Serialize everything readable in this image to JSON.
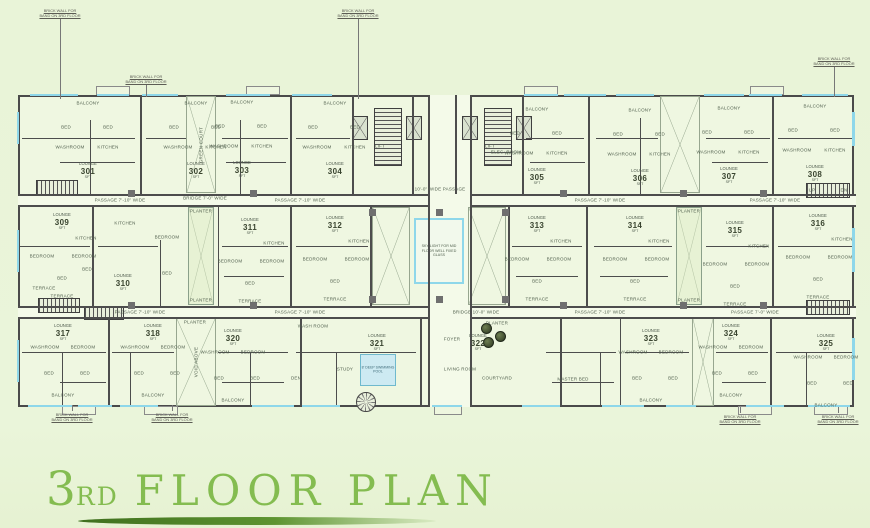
{
  "title": {
    "ordinal_number": "3",
    "ordinal_suffix": "RD",
    "main": "FLOOR PLAN"
  },
  "colors": {
    "background": "#e9f4d8",
    "plan_fill": "#eff7e1",
    "wall": "#4d4d4d",
    "window": "#8ed7ea",
    "title_green": "#84bc50",
    "swoosh_green": "#4a7b24",
    "tiny_text": "#51604e"
  },
  "plan": {
    "unit_top_label": "LOUNGE",
    "unit_area_unit": "SFT",
    "brick_note": [
      "BRICK WALL FOR",
      "BAND ON 3RD FLOOR"
    ],
    "units": [
      [
        "301",
        88,
        171,
        "top"
      ],
      [
        "302",
        196,
        171,
        "top"
      ],
      [
        "303",
        242,
        170,
        "top"
      ],
      [
        "304",
        335,
        171,
        "top"
      ],
      [
        "305",
        537,
        177,
        "top"
      ],
      [
        "306",
        640,
        178,
        "top"
      ],
      [
        "307",
        729,
        176,
        "top"
      ],
      [
        "308",
        815,
        174,
        "top"
      ],
      [
        "309",
        62,
        222,
        "mid"
      ],
      [
        "310",
        123,
        283,
        "mid2"
      ],
      [
        "311",
        250,
        227,
        "mid"
      ],
      [
        "312",
        335,
        225,
        "mid"
      ],
      [
        "313",
        537,
        225,
        "mid"
      ],
      [
        "314",
        635,
        225,
        "mid"
      ],
      [
        "315",
        735,
        230,
        "mid"
      ],
      [
        "316",
        818,
        223,
        "mid"
      ],
      [
        "317",
        63,
        333,
        "bottom"
      ],
      [
        "318",
        153,
        333,
        "bottom"
      ],
      [
        "320",
        233,
        338,
        "bottom"
      ],
      [
        "321",
        377,
        343,
        "none"
      ],
      [
        "322",
        478,
        343,
        "none"
      ],
      [
        "323",
        651,
        338,
        "bottom"
      ],
      [
        "324",
        731,
        333,
        "bottom"
      ],
      [
        "325",
        826,
        343,
        "bottom"
      ]
    ],
    "room_patterns": {
      "top": [
        [
          "BALCONY",
          0,
          -68
        ],
        [
          "BED",
          -22,
          -44
        ],
        [
          "BED",
          20,
          -44
        ],
        [
          "WASHROOM",
          -18,
          -24
        ],
        [
          "KITCHEN",
          20,
          -24
        ]
      ],
      "mid": [
        [
          "KITCHEN",
          24,
          16
        ],
        [
          "BEDROOM",
          -20,
          34
        ],
        [
          "BEDROOM",
          22,
          34
        ],
        [
          "BED",
          0,
          56
        ],
        [
          "TERRACE",
          0,
          74
        ]
      ],
      "mid2": [
        [
          "BEDROOM",
          44,
          -46
        ],
        [
          "KITCHEN",
          2,
          -60
        ],
        [
          "BED",
          -36,
          -14
        ],
        [
          "BED",
          44,
          -10
        ]
      ],
      "bottom": [
        [
          "WASHROOM",
          -18,
          14
        ],
        [
          "BEDROOM",
          20,
          14
        ],
        [
          "BED",
          -14,
          40
        ],
        [
          "BED",
          22,
          40
        ],
        [
          "BALCONY",
          0,
          62
        ]
      ],
      "none": []
    },
    "corridors": [
      [
        18,
        196,
        410,
        9
      ],
      [
        470,
        196,
        386,
        9
      ],
      [
        18,
        308,
        410,
        9
      ],
      [
        470,
        308,
        386,
        9
      ],
      [
        429.5,
        95,
        40.5,
        312
      ]
    ],
    "walls": [
      [
        18,
        194,
        410,
        1.5
      ],
      [
        470,
        194,
        386,
        1.5
      ],
      [
        18,
        205,
        410,
        1.5
      ],
      [
        470,
        205,
        386,
        1.5
      ],
      [
        18,
        306,
        410,
        1.5
      ],
      [
        470,
        306,
        386,
        1.5
      ],
      [
        18,
        317,
        410,
        1.5
      ],
      [
        470,
        317,
        386,
        1.5
      ],
      [
        428,
        95,
        1.5,
        312
      ],
      [
        470,
        95,
        1.5,
        312
      ],
      [
        140,
        95,
        1.5,
        99
      ],
      [
        290,
        95,
        1.5,
        99
      ],
      [
        352,
        95,
        1.5,
        99
      ],
      [
        412,
        95,
        1.5,
        99
      ],
      [
        455,
        95,
        1.5,
        99
      ],
      [
        522,
        95,
        1.5,
        99
      ],
      [
        588,
        95,
        1.5,
        99
      ],
      [
        772,
        95,
        1.5,
        99
      ],
      [
        90,
        120,
        1,
        74
      ],
      [
        240,
        120,
        1,
        74
      ],
      [
        640,
        118,
        1,
        76
      ],
      [
        22,
        138,
        113,
        1
      ],
      [
        146,
        138,
        40,
        1
      ],
      [
        222,
        138,
        66,
        1
      ],
      [
        296,
        138,
        54,
        1
      ],
      [
        526,
        138,
        58,
        1
      ],
      [
        596,
        138,
        62,
        1
      ],
      [
        706,
        138,
        64,
        1
      ],
      [
        778,
        138,
        76,
        1
      ],
      [
        60,
        162,
        75,
        1
      ],
      [
        226,
        162,
        60,
        1
      ],
      [
        530,
        162,
        55,
        1
      ],
      [
        712,
        162,
        56,
        1
      ],
      [
        92,
        206,
        1.5,
        100
      ],
      [
        290,
        206,
        1.5,
        100
      ],
      [
        586,
        206,
        1.5,
        100
      ],
      [
        772,
        206,
        1.5,
        100
      ],
      [
        370,
        206,
        1.5,
        100
      ],
      [
        508,
        206,
        1.5,
        100
      ],
      [
        160,
        240,
        1,
        66
      ],
      [
        218,
        206,
        1,
        100
      ],
      [
        20,
        246,
        70,
        1
      ],
      [
        98,
        246,
        60,
        1
      ],
      [
        222,
        246,
        66,
        1
      ],
      [
        296,
        246,
        72,
        1
      ],
      [
        512,
        246,
        70,
        1
      ],
      [
        594,
        246,
        78,
        1
      ],
      [
        706,
        246,
        62,
        1
      ],
      [
        778,
        246,
        74,
        1
      ],
      [
        224,
        276,
        60,
        1
      ],
      [
        516,
        276,
        62,
        1
      ],
      [
        600,
        276,
        68,
        1
      ],
      [
        108,
        318,
        1.5,
        88
      ],
      [
        300,
        318,
        1.5,
        88
      ],
      [
        420,
        318,
        1.5,
        88
      ],
      [
        560,
        318,
        1.5,
        88
      ],
      [
        620,
        318,
        1,
        88
      ],
      [
        770,
        318,
        1.5,
        88
      ],
      [
        62,
        352,
        1,
        54
      ],
      [
        130,
        352,
        1,
        54
      ],
      [
        250,
        352,
        1,
        54
      ],
      [
        336,
        352,
        1,
        54
      ],
      [
        600,
        352,
        1,
        54
      ],
      [
        806,
        352,
        1,
        54
      ],
      [
        22,
        352,
        84,
        1
      ],
      [
        112,
        352,
        62,
        1
      ],
      [
        218,
        352,
        70,
        1
      ],
      [
        296,
        352,
        120,
        1
      ],
      [
        546,
        352,
        70,
        1
      ],
      [
        625,
        352,
        64,
        1
      ],
      [
        716,
        352,
        52,
        1
      ],
      [
        776,
        352,
        76,
        1
      ],
      [
        60,
        382,
        46,
        1
      ],
      [
        222,
        382,
        62,
        1
      ],
      [
        552,
        382,
        62,
        1
      ],
      [
        722,
        382,
        44,
        1
      ]
    ],
    "windows": [
      [
        30,
        93.5,
        48,
        2.5
      ],
      [
        97,
        93.5,
        32,
        2.5
      ],
      [
        142,
        93.5,
        36,
        2.5
      ],
      [
        226,
        93.5,
        44,
        2.5
      ],
      [
        292,
        93.5,
        40,
        2.5
      ],
      [
        524,
        93.5,
        34,
        2.5
      ],
      [
        564,
        93.5,
        42,
        2.5
      ],
      [
        616,
        93.5,
        38,
        2.5
      ],
      [
        704,
        93.5,
        40,
        2.5
      ],
      [
        749,
        93.5,
        33,
        2.5
      ],
      [
        802,
        93.5,
        46,
        2.5
      ],
      [
        28,
        404.5,
        44,
        2.5
      ],
      [
        78,
        404.5,
        34,
        2.5
      ],
      [
        120,
        404.5,
        38,
        2.5
      ],
      [
        252,
        404.5,
        42,
        2.5
      ],
      [
        302,
        404.5,
        38,
        2.5
      ],
      [
        432,
        404.5,
        30,
        2.5
      ],
      [
        522,
        404.5,
        38,
        2.5
      ],
      [
        602,
        404.5,
        42,
        2.5
      ],
      [
        666,
        404.5,
        30,
        2.5
      ],
      [
        746,
        404.5,
        38,
        2.5
      ],
      [
        808,
        404.5,
        42,
        2.5
      ],
      [
        16.5,
        112,
        2.5,
        32
      ],
      [
        16.5,
        230,
        2.5,
        42
      ],
      [
        16.5,
        340,
        2.5,
        42
      ],
      [
        852,
        112,
        2.5,
        34
      ],
      [
        852,
        228,
        2.5,
        44
      ],
      [
        852,
        338,
        2.5,
        42
      ]
    ],
    "bumps": [
      [
        96,
        86,
        34,
        9
      ],
      [
        246,
        86,
        34,
        9
      ],
      [
        524,
        86,
        34,
        9
      ],
      [
        750,
        86,
        34,
        9
      ],
      [
        62,
        406,
        34,
        9
      ],
      [
        144,
        406,
        34,
        9
      ],
      [
        434,
        406,
        28,
        9
      ],
      [
        738,
        406,
        34,
        9
      ],
      [
        814,
        406,
        34,
        9
      ]
    ],
    "columns": [
      [
        369,
        209
      ],
      [
        436,
        209
      ],
      [
        502,
        209
      ],
      [
        369,
        296
      ],
      [
        436,
        296
      ],
      [
        502,
        296
      ],
      [
        128,
        190
      ],
      [
        128,
        302
      ],
      [
        250,
        190
      ],
      [
        250,
        302
      ],
      [
        560,
        190
      ],
      [
        560,
        302
      ],
      [
        680,
        190
      ],
      [
        680,
        302
      ],
      [
        760,
        190
      ],
      [
        760,
        302
      ]
    ],
    "stairs": [
      [
        36,
        180,
        42,
        15,
        "h"
      ],
      [
        38,
        298,
        42,
        15,
        "h"
      ],
      [
        806,
        183,
        44,
        15,
        "h"
      ],
      [
        806,
        300,
        44,
        15,
        "h"
      ],
      [
        374,
        108,
        28,
        58,
        "v"
      ],
      [
        484,
        108,
        28,
        58,
        "v"
      ],
      [
        84,
        307,
        40,
        13,
        "h"
      ]
    ],
    "lifts": [
      [
        352,
        116,
        16,
        24
      ],
      [
        406,
        116,
        16,
        24
      ],
      [
        462,
        116,
        16,
        24
      ],
      [
        516,
        116,
        16,
        24
      ]
    ],
    "lift_label": "LIFT",
    "voids": [
      [
        186,
        96,
        30,
        97,
        "GREEN COURT"
      ],
      [
        660,
        96,
        40,
        97,
        ""
      ],
      [
        176,
        318,
        40,
        88,
        "VOID ABOVE"
      ],
      [
        372,
        207,
        38,
        98,
        ""
      ],
      [
        468,
        207,
        38,
        98,
        ""
      ],
      [
        692,
        318,
        22,
        88,
        ""
      ]
    ],
    "planter_strips": [
      [
        188,
        207,
        26,
        98
      ],
      [
        676,
        207,
        26,
        98
      ]
    ],
    "skylight": {
      "x": 414,
      "y": 218,
      "w": 50,
      "h": 66,
      "label": "SKY LIGHT FOR MID FLOOR WELL FIXED GLASS"
    },
    "pool": {
      "x": 360,
      "y": 354,
      "w": 36,
      "h": 32,
      "label": "8' DEEP SWIMMING POOL"
    },
    "trees": [
      [
        481,
        323
      ],
      [
        495,
        331
      ],
      [
        483,
        337
      ]
    ],
    "spiral_stair": [
      356,
      392,
      20,
      20
    ],
    "labels": [
      [
        "PASSAGE 7'-10\" WIDE",
        120,
        200
      ],
      [
        "PASSAGE 7'-10\" WIDE",
        300,
        200
      ],
      [
        "PASSAGE 7'-10\" WIDE",
        600,
        200
      ],
      [
        "PASSAGE 7'-10\" WIDE",
        775,
        200
      ],
      [
        "PASSAGE 7'-10\" WIDE",
        140,
        312
      ],
      [
        "PASSAGE 7'-10\" WIDE",
        300,
        312
      ],
      [
        "PASSAGE 7'-10\" WIDE",
        600,
        312
      ],
      [
        "PASSAGE 7'-0\" WIDE",
        755,
        312
      ],
      [
        "10'-0\" WIDE PASSAGE",
        440,
        189
      ],
      [
        "BRIDGE 10'-0\" WIDE",
        476,
        312
      ],
      [
        "BRIDGE 7'-0\" WIDE",
        205,
        198
      ],
      [
        "PLANTER",
        201,
        211
      ],
      [
        "PLANTER",
        201,
        300
      ],
      [
        "PLANTER",
        689,
        211
      ],
      [
        "PLANTER",
        689,
        300
      ],
      [
        "PLANTER",
        195,
        322
      ],
      [
        "PLANTER",
        497,
        323
      ],
      [
        "ELEC. ROOM",
        506,
        152
      ],
      [
        "LIVING ROOM",
        460,
        369
      ],
      [
        "COURTYARD",
        497,
        378
      ],
      [
        "FOYER",
        452,
        339
      ],
      [
        "STUDY",
        345,
        369
      ],
      [
        "DEN",
        296,
        378
      ],
      [
        "WASH ROOM",
        313,
        326
      ],
      [
        "MASTER BED",
        573,
        379
      ],
      [
        "UP",
        812,
        190
      ],
      [
        "DN",
        844,
        190
      ],
      [
        "TERRACE",
        44,
        288
      ]
    ],
    "annotations": [
      [
        60,
        8,
        "d",
        80
      ],
      [
        358,
        8,
        "d",
        80
      ],
      [
        146,
        74,
        "d",
        12
      ],
      [
        834,
        56,
        "d",
        30
      ],
      [
        72,
        412,
        "u",
        6
      ],
      [
        172,
        412,
        "u",
        6
      ],
      [
        740,
        414,
        "u",
        6
      ],
      [
        838,
        414,
        "u",
        6
      ]
    ]
  }
}
